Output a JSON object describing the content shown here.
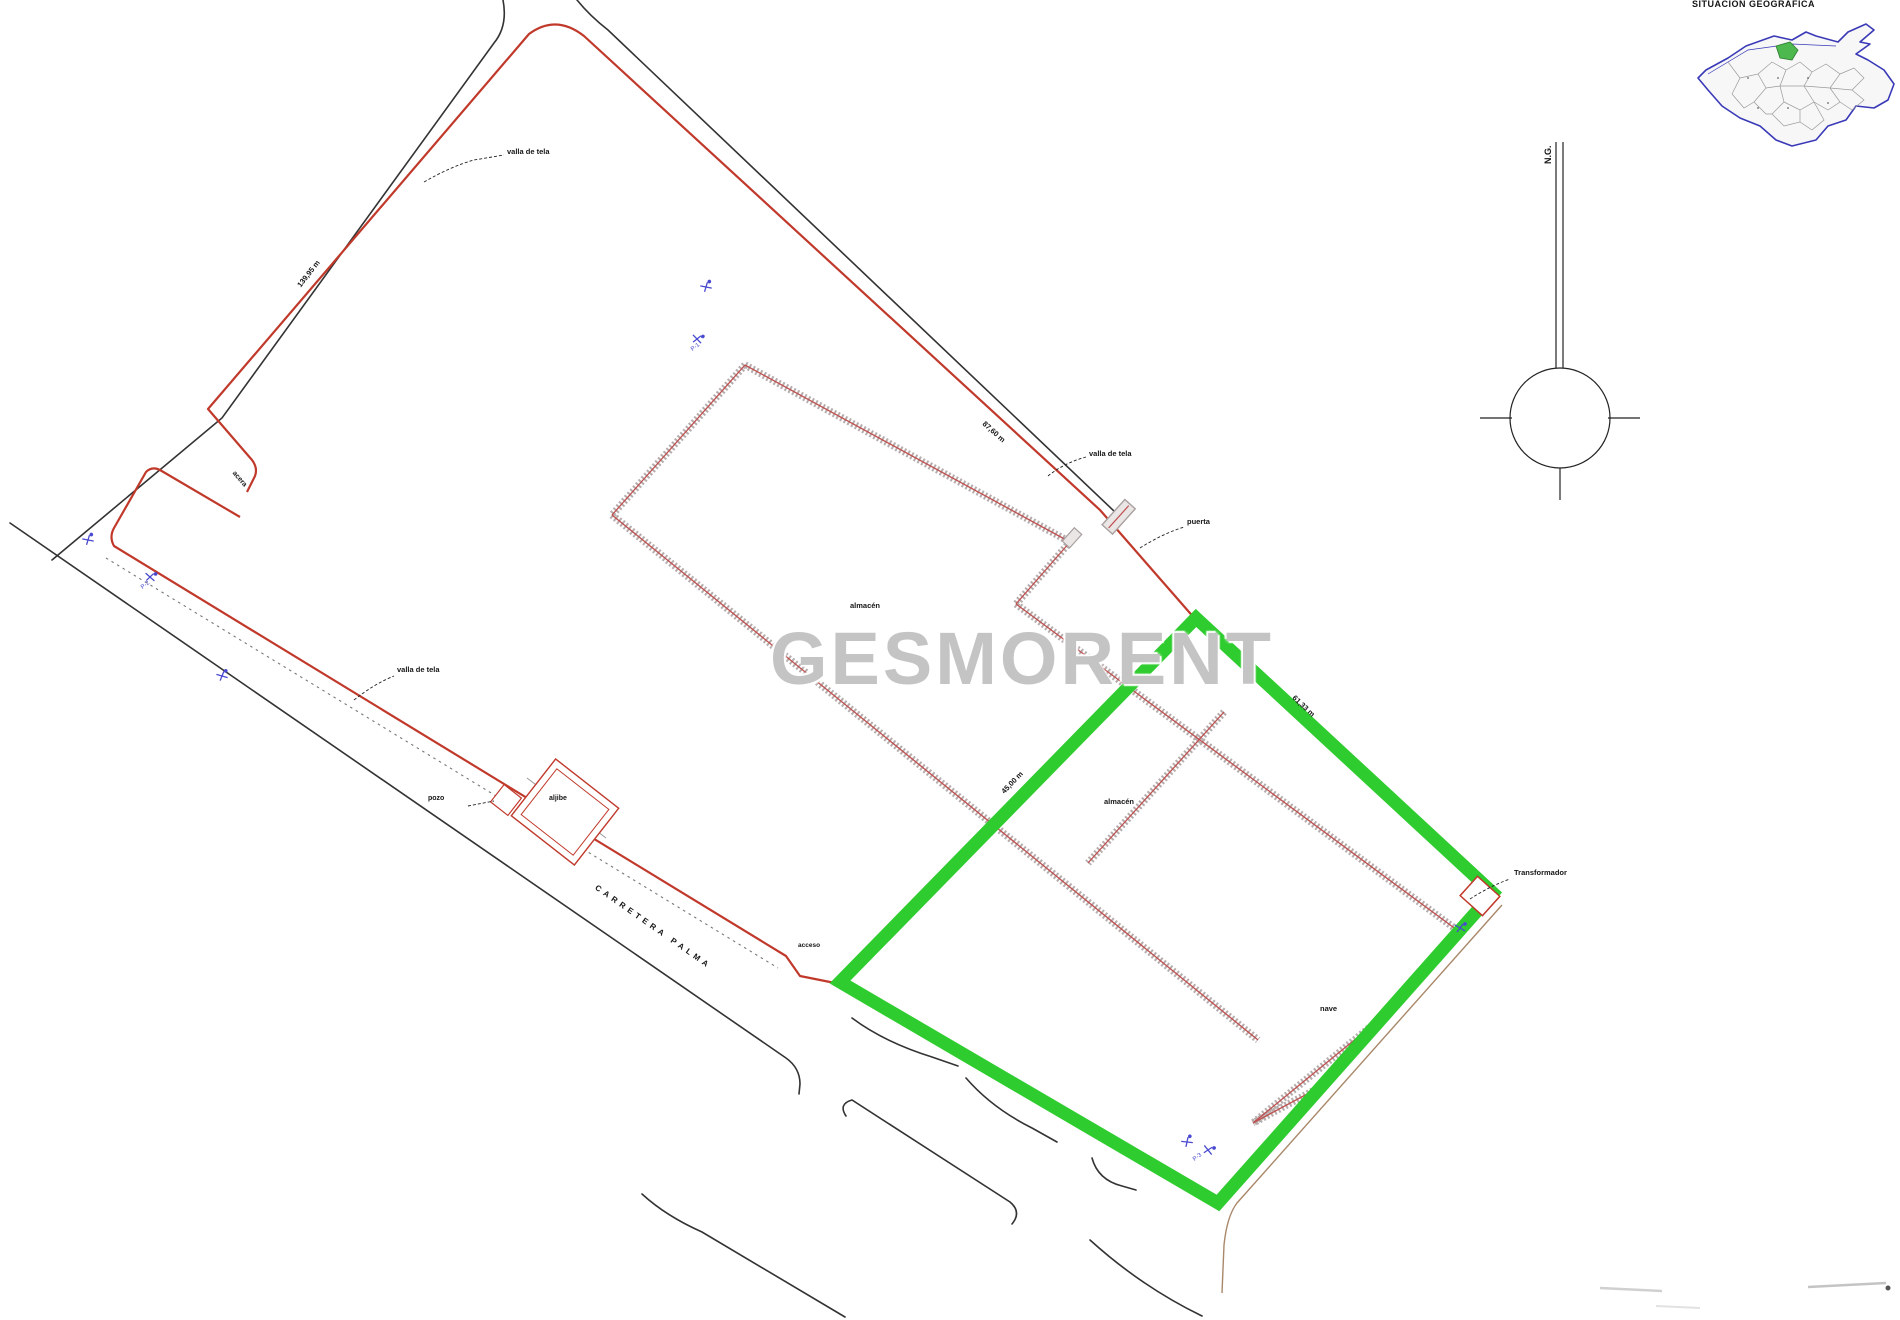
{
  "watermark": {
    "text": "GESMORENT",
    "color": "#c4c4c4"
  },
  "locator_map": {
    "title": "SITUACIÓN GEOGRÁFICA",
    "island_outline_color": "#3a3ab8",
    "municipality_line_color": "#9a9a9a",
    "highlight_color": "#4db84d"
  },
  "north_arrow": {
    "label": "N.G."
  },
  "street": {
    "name": "CARRETERA PALMA"
  },
  "colors": {
    "parcel_boundary": "#c0392b",
    "highlight_green": "#2ecc2e",
    "road_line": "#333333",
    "wall_gray": "#b6acac",
    "wall_center_red": "#c05050",
    "marker_blue": "#4a4ad0",
    "watermark_gray": "#c4c4c4"
  },
  "buildings": {
    "hall_a_label": "almacén",
    "hall_b_label": "almacén",
    "hall_c_label": "nave",
    "cistern_label": "aljibe",
    "well_label": "pozo",
    "transformer_label": "Transformador"
  },
  "boundary_labels": {
    "left_dim": "139,95 m",
    "ne_dim": "87,60 m",
    "green_left_dim": "45,00 m",
    "green_ne_dim": "61,33 m",
    "fence": "valla de tela",
    "sidewalk": "acera",
    "gate": "puerta",
    "access": "acceso"
  },
  "annotations": [
    {
      "name": "map-title",
      "text": "SITUACIÓN GEOGRÁFICA",
      "x": 1692,
      "y": 0,
      "rot": 0,
      "size": 9,
      "weight": 700,
      "spacing": 0.5
    },
    {
      "name": "north-label",
      "text": "N.G.",
      "x": 1544,
      "y": 164,
      "rot": -90,
      "size": 9,
      "weight": 700
    },
    {
      "name": "fence-label-1",
      "text": "valla de tela",
      "x": 507,
      "y": 148,
      "rot": 0,
      "size": 7.5,
      "weight": 700
    },
    {
      "name": "dim-left-edge",
      "text": "139,95 m",
      "x": 296,
      "y": 284,
      "rot": -52,
      "size": 7.5,
      "weight": 700
    },
    {
      "name": "sidewalk-label",
      "text": "acera",
      "x": 236,
      "y": 470,
      "rot": 49,
      "size": 7,
      "weight": 700
    },
    {
      "name": "dim-ne-edge",
      "text": "87,60 m",
      "x": 986,
      "y": 420,
      "rot": 42,
      "size": 7.5,
      "weight": 700
    },
    {
      "name": "fence-label-2",
      "text": "valla de tela",
      "x": 1089,
      "y": 450,
      "rot": 0,
      "size": 7.5,
      "weight": 700
    },
    {
      "name": "gate-label",
      "text": "puerta",
      "x": 1187,
      "y": 518,
      "rot": 0,
      "size": 7.5,
      "weight": 700
    },
    {
      "name": "fence-label-3",
      "text": "valla de tela",
      "x": 397,
      "y": 666,
      "rot": 0,
      "size": 7.5,
      "weight": 700
    },
    {
      "name": "well-label",
      "text": "pozo",
      "x": 428,
      "y": 795,
      "rot": 0,
      "size": 7,
      "weight": 700
    },
    {
      "name": "cistern-label",
      "text": "aljibe",
      "x": 549,
      "y": 795,
      "rot": 0,
      "size": 7,
      "weight": 700
    },
    {
      "name": "street-name",
      "text": "CARRETERA PALMA",
      "x": 598,
      "y": 884,
      "rot": 35,
      "size": 8,
      "weight": 700,
      "spacing": 4
    },
    {
      "name": "access-label",
      "text": "acceso",
      "x": 798,
      "y": 943,
      "rot": 0,
      "size": 6.5,
      "weight": 700
    },
    {
      "name": "dim-green-left",
      "text": "45,00 m",
      "x": 1000,
      "y": 790,
      "rot": -46,
      "size": 7.5,
      "weight": 700
    },
    {
      "name": "dim-green-ne",
      "text": "61,33 m",
      "x": 1296,
      "y": 694,
      "rot": 43,
      "size": 7.5,
      "weight": 700
    },
    {
      "name": "transformer-label",
      "text": "Transformador",
      "x": 1514,
      "y": 869,
      "rot": 0,
      "size": 7.5,
      "weight": 700
    },
    {
      "name": "hall-a-label",
      "text": "almacén",
      "x": 850,
      "y": 602,
      "rot": 0,
      "size": 7.5,
      "weight": 700
    },
    {
      "name": "hall-b-label",
      "text": "almacén",
      "x": 1104,
      "y": 798,
      "rot": 0,
      "size": 7.5,
      "weight": 700
    },
    {
      "name": "hall-c-label",
      "text": "nave",
      "x": 1320,
      "y": 1005,
      "rot": 0,
      "size": 7.5,
      "weight": 700
    },
    {
      "name": "marker-label-1",
      "text": "P-1",
      "x": 690,
      "y": 348,
      "rot": -38,
      "size": 6,
      "weight": 400,
      "color": "#4a4ad0"
    },
    {
      "name": "marker-label-2",
      "text": "P-2",
      "x": 140,
      "y": 586,
      "rot": -38,
      "size": 6,
      "weight": 400,
      "color": "#4a4ad0"
    },
    {
      "name": "marker-label-3",
      "text": "P-3",
      "x": 1192,
      "y": 1158,
      "rot": -38,
      "size": 6,
      "weight": 400,
      "color": "#4a4ad0"
    }
  ],
  "survey_markers": [
    {
      "x": 706,
      "y": 287,
      "rot": -20
    },
    {
      "x": 697,
      "y": 339,
      "rot": 15
    },
    {
      "x": 88,
      "y": 540,
      "rot": -20
    },
    {
      "x": 150,
      "y": 577,
      "rot": 10
    },
    {
      "x": 222,
      "y": 676,
      "rot": -15
    },
    {
      "x": 1460,
      "y": 928,
      "rot": 0
    },
    {
      "x": 1187,
      "y": 1142,
      "rot": -25
    },
    {
      "x": 1208,
      "y": 1150,
      "rot": 20
    }
  ]
}
